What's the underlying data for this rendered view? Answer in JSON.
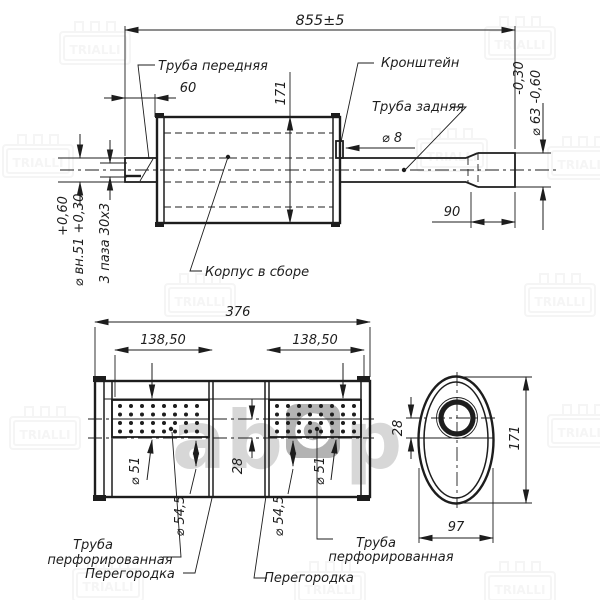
{
  "colors": {
    "background": "#ffffff",
    "line": "#1d1d1d",
    "watermark_gray": "#d0d0d0",
    "watermark_tile": "#a6a6a6"
  },
  "watermark": {
    "brand": "TRIALLI",
    "center_left": "ab",
    "center_right": "p"
  },
  "side_view": {
    "total_length": "855±5",
    "front_pipe_length": "60",
    "body_height": "171",
    "front_pipe_label": "Труба передняя",
    "bracket_label": "Кронштейн",
    "rear_pipe_label": "Труба задняя",
    "bracket_rod_dia": "⌀ 8",
    "tip_dia_tol": "-0,30",
    "tip_dia": "⌀ 63 -0,60",
    "inlet_dia_tol": "+0,60",
    "inlet_dia": "⌀ вн.51 +0,30",
    "slots_note": "3 паза 30х3",
    "tip_length": "90",
    "body_label": "Корпус в сборе"
  },
  "section_view": {
    "total_length": "376",
    "left_chamber": "138,50",
    "right_chamber": "138,50",
    "pipe_dia_left": "⌀ 51",
    "pipe_dia_right": "⌀ 51",
    "pipe_outer_dia_left": "⌀ 54,5",
    "pipe_outer_dia_right": "⌀ 54,5",
    "axis_offset": "28",
    "perf_label_line1": "Труба",
    "perf_label_line2": "перфорированная",
    "partition_left": "Перегородка",
    "partition_right": "Перегородка"
  },
  "end_view": {
    "axis_offset": "28",
    "height": "171",
    "width": "97"
  }
}
